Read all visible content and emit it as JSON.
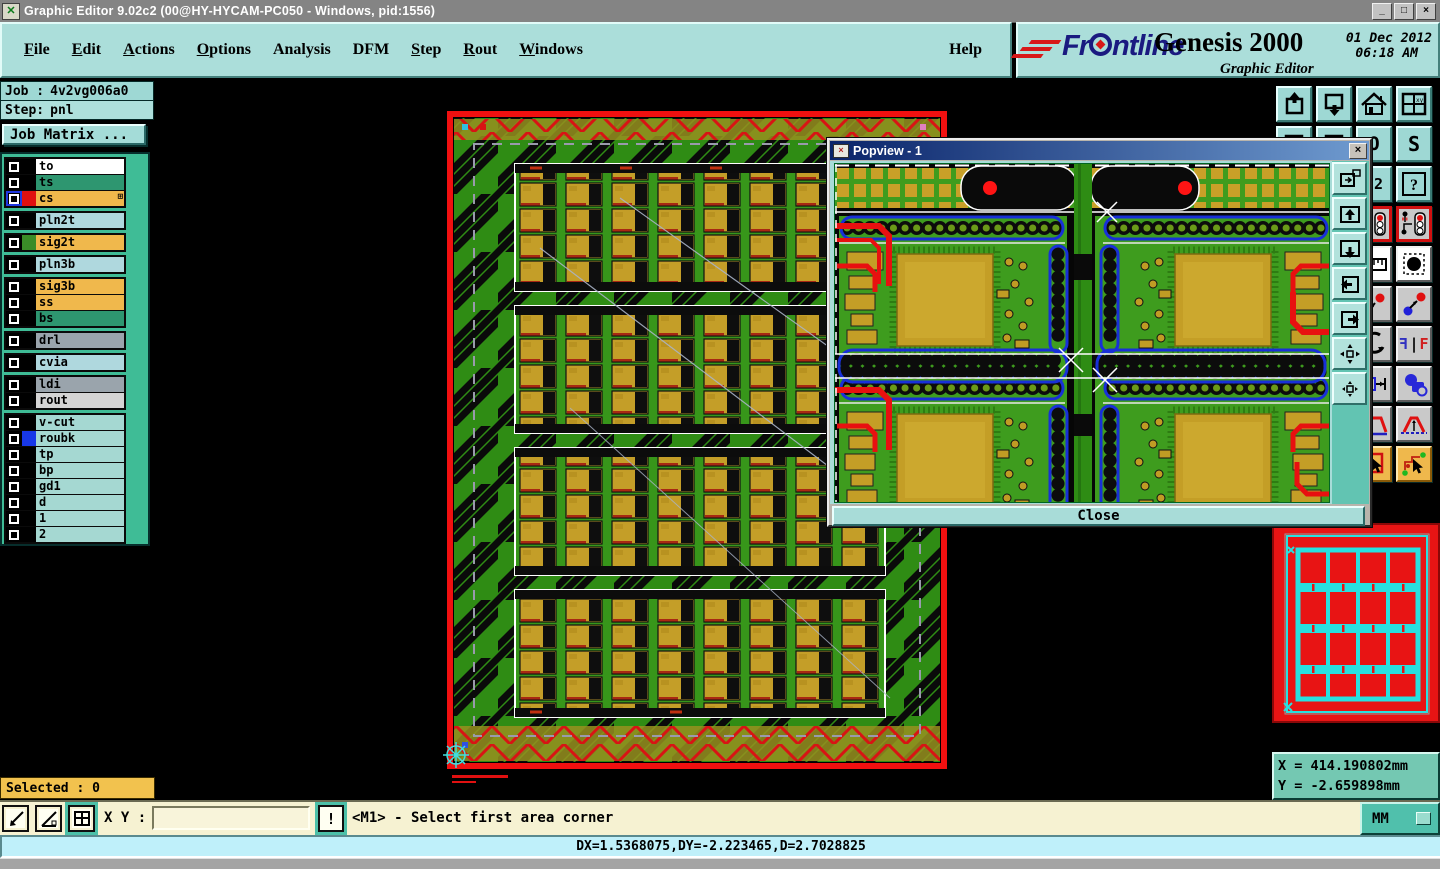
{
  "titlebar": {
    "title": "Graphic Editor 9.02c2 (00@HY-HYCAM-PC050 - Windows, pid:1556)",
    "minimize": "_",
    "maximize": "□",
    "close": "×"
  },
  "menu": {
    "items": [
      {
        "head": "F",
        "tail": "ile"
      },
      {
        "head": "E",
        "tail": "dit"
      },
      {
        "head": "A",
        "tail": "ctions"
      },
      {
        "head": "O",
        "tail": "ptions"
      },
      {
        "head": "",
        "tail": "Analysis"
      },
      {
        "head": "",
        "tail": "DFM"
      },
      {
        "head": "S",
        "tail": "tep"
      },
      {
        "head": "R",
        "tail": "out"
      },
      {
        "head": "W",
        "tail": "indows"
      }
    ],
    "help": "Help"
  },
  "brand": {
    "name_pre": "Fr",
    "name_post": "ntline",
    "product": "Genesis 2000",
    "subtitle": "Graphic Editor",
    "date": "01 Dec 2012",
    "time": "06:18 AM"
  },
  "sidebar": {
    "job_label": "Job :",
    "job_value": "4v2vg006a0",
    "step_label": "Step:",
    "step_value": "pnl",
    "matrix_button": "Job Matrix ...",
    "selected": "Selected : 0",
    "layers": [
      {
        "name": "to",
        "row": "#ffffff",
        "swatch": "#000000"
      },
      {
        "name": "ts",
        "row": "#2e9670",
        "swatch": "#000000"
      },
      {
        "name": "cs",
        "row": "#f0b84c",
        "swatch": "#e01010",
        "badge": "⊞"
      },
      {
        "name": "pln2t",
        "row": "#afd8de",
        "swatch": "#000000"
      },
      {
        "name": "sig2t",
        "row": "#f0b84c",
        "swatch": "#3a8c28"
      },
      {
        "name": "pln3b",
        "row": "#afd8de",
        "swatch": "#000000"
      },
      {
        "name": "sig3b",
        "row": "#f0b84c",
        "swatch": "#000000"
      },
      {
        "name": "ss",
        "row": "#f0b84c",
        "swatch": "#000000"
      },
      {
        "name": "bs",
        "row": "#2e9670",
        "swatch": "#000000"
      },
      {
        "name": "drl",
        "row": "#9aa4ac",
        "swatch": "#000000"
      },
      {
        "name": "cvia",
        "row": "#afd8de",
        "swatch": "#000000"
      },
      {
        "name": "ldi",
        "row": "#9aa4ac",
        "swatch": "#000000"
      },
      {
        "name": "rout",
        "row": "#d4d4d4",
        "swatch": "#000000"
      },
      {
        "name": "v-cut",
        "row": "#a5d8d2",
        "swatch": "#000000"
      },
      {
        "name": "roubk",
        "row": "#a5d8d2",
        "swatch": "#1838e8"
      },
      {
        "name": "tp",
        "row": "#a5d8d2",
        "swatch": "#000000"
      },
      {
        "name": "bp",
        "row": "#a5d8d2",
        "swatch": "#000000"
      },
      {
        "name": "gd1",
        "row": "#a5d8d2",
        "swatch": "#000000"
      },
      {
        "name": "d",
        "row": "#a5d8d2",
        "swatch": "#000000"
      },
      {
        "name": "1",
        "row": "#a5d8d2",
        "swatch": "#000000"
      },
      {
        "name": "2",
        "row": "#a5d8d2",
        "swatch": "#000000"
      }
    ]
  },
  "toolbar": {
    "labels": {
      "o": "O",
      "s": "S",
      "ratio": ":2",
      "help": "?",
      "xy": "xy",
      "f": "F",
      "bar": "|"
    }
  },
  "popview": {
    "title": "Popview - 1",
    "icon": "×",
    "close_x": "×",
    "close_button": "Close"
  },
  "overview": {
    "x_line": "X = 414.190802mm",
    "y_line": "Y = -2.659898mm"
  },
  "statusbar": {
    "xy_label": "X Y :",
    "xy_value": "",
    "alert": "!",
    "prompt": "<M1> - Select first area corner",
    "units": "MM",
    "readout": "DX=1.5368075,DY=-2.223465,D=2.7028825"
  },
  "colors": {
    "chrome_teal": "#abdeda",
    "canvas_black": "#000000",
    "panel_green": "#2f8c14",
    "copper_gold": "#c49e28",
    "trace_red": "#e81010",
    "outline_blue": "#1830d8",
    "overview_red": "#e81414",
    "overview_cyan": "#28e0e0",
    "selected_orange": "#f2c24e"
  }
}
